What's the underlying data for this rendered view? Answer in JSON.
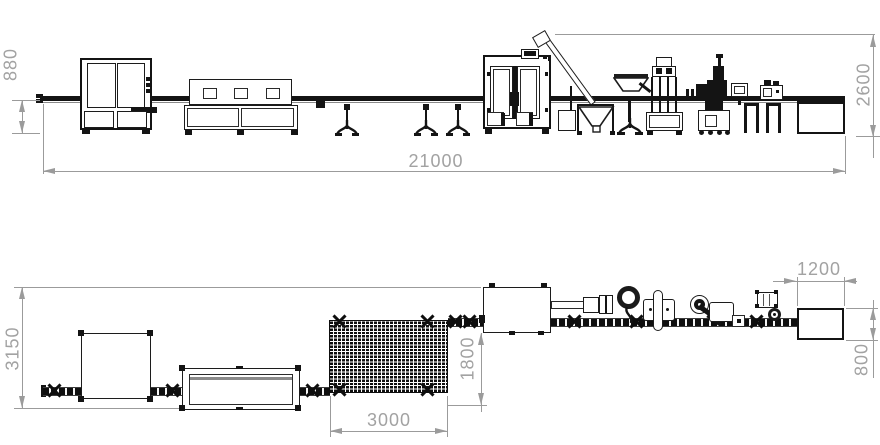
{
  "drawing": {
    "type": "engineering-layout",
    "dimension_labels": {
      "elevation": {
        "conveyor_height": "880",
        "overall_height": "2600",
        "overall_length": "21000"
      },
      "plan": {
        "overall_depth": "3150",
        "buffer_offset": "1800",
        "buffer_length": "3000",
        "outfeed_table_length": "1200",
        "outfeed_table_depth": "800"
      }
    },
    "colors": {
      "background": "#ffffff",
      "machine_line": "#1c1c1c",
      "dimension_line": "#9b9b9b",
      "dimension_text": "#a2a2a2"
    }
  }
}
